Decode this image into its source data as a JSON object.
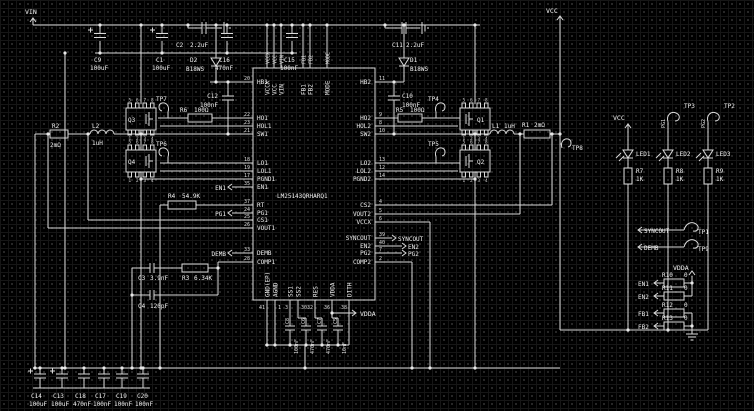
{
  "colors": {
    "bg": "#000000",
    "grid": "#343434",
    "wire": "#d9d9d9",
    "text": "#f1f1f1"
  },
  "nets": {
    "vin": "VIN",
    "vcc": "VCC",
    "vdda": "VDDA",
    "en1": "EN1",
    "en2": "EN2",
    "pg1": "PG1",
    "pg2": "PG2",
    "fb1": "FB1",
    "fb2": "FB2",
    "demb": "DEMB",
    "syncout": "SYNCOUT"
  },
  "ic": {
    "name": "LM25143QRHARQ1",
    "left_pins": [
      {
        "num": "20",
        "name": "HB1"
      },
      {
        "num": "22",
        "name": "HO1"
      },
      {
        "num": "23",
        "name": "HOL1"
      },
      {
        "num": "21",
        "name": "SW1"
      },
      {
        "num": "18",
        "name": "LO1"
      },
      {
        "num": "19",
        "name": "LOL1"
      },
      {
        "num": "17",
        "name": "PGND1"
      },
      {
        "num": "35",
        "name": "EN1"
      },
      {
        "num": "37",
        "name": "RT"
      },
      {
        "num": "24",
        "name": "PG1"
      },
      {
        "num": "25",
        "name": "CS1"
      },
      {
        "num": "26",
        "name": "VOUT1"
      },
      {
        "num": "33",
        "name": "DEMB"
      },
      {
        "num": "28",
        "name": "COMP1"
      }
    ],
    "right_pins": [
      {
        "num": "11",
        "name": "HB2"
      },
      {
        "num": "9",
        "name": "HO2"
      },
      {
        "num": "8",
        "name": "HOL2"
      },
      {
        "num": "10",
        "name": "SW2"
      },
      {
        "num": "13",
        "name": "LO2"
      },
      {
        "num": "12",
        "name": "LOL2"
      },
      {
        "num": "14",
        "name": "PGND2"
      },
      {
        "num": "4",
        "name": "CS2"
      },
      {
        "num": "5",
        "name": "VOUT2"
      },
      {
        "num": "6",
        "name": "VCCX"
      },
      {
        "num": "39",
        "name": "SYNCOUT"
      },
      {
        "num": "40",
        "name": "EN2"
      },
      {
        "num": "7",
        "name": "PG2"
      },
      {
        "num": "2",
        "name": "COMP2"
      }
    ],
    "top_pins": [
      "VCCX",
      "VCC",
      "VIN",
      "FB1",
      "FB2",
      "MODE"
    ],
    "bottom_pins": [
      {
        "num": "41",
        "name": "GND(EP)"
      },
      {
        "num": "1",
        "name": "AGND"
      },
      {
        "num": "3",
        "name": "SS1"
      },
      {
        "num": "30",
        "name": "SS2"
      },
      {
        "num": "32",
        "name": "RES"
      },
      {
        "num": "36",
        "name": "VDDA"
      },
      {
        "num": "38",
        "name": "DITH"
      }
    ]
  },
  "input_caps": [
    {
      "ref": "C9",
      "value": "100uF"
    },
    {
      "ref": "C1",
      "value": "100uF"
    },
    {
      "ref": "C16",
      "value": "470nF"
    },
    {
      "ref": "C15",
      "value": "100nF"
    }
  ],
  "output_caps": [
    {
      "ref": "C14",
      "value": "100uF"
    },
    {
      "ref": "C13",
      "value": "100uF"
    },
    {
      "ref": "C18",
      "value": "470nF"
    },
    {
      "ref": "C17",
      "value": "100nF"
    },
    {
      "ref": "C19",
      "value": "100nF"
    },
    {
      "ref": "C20",
      "value": "100nF"
    }
  ],
  "decoupling_caps": [
    {
      "ref": "C8",
      "value": "100nF"
    },
    {
      "ref": "C6",
      "value": "470nF"
    },
    {
      "ref": "C7",
      "value": "470nF"
    },
    {
      "ref": "C5",
      "value": "10nF"
    }
  ],
  "ch1": {
    "c2": {
      "ref": "C2",
      "value": "2.2uF"
    },
    "d2": {
      "ref": "D2",
      "value": "B18WS"
    },
    "c12": {
      "ref": "C12",
      "value": "100nF"
    },
    "r6": {
      "ref": "R6",
      "value": "100Ω"
    },
    "q3": "Q3",
    "q4": "Q4",
    "l2": {
      "ref": "L2",
      "value": "1uH"
    },
    "r2": {
      "ref": "R2",
      "value": "2mΩ"
    },
    "r4": {
      "ref": "R4",
      "value": "54.9K"
    },
    "c3": {
      "ref": "C3",
      "value": "3.9nF"
    },
    "r3": {
      "ref": "R3",
      "value": "6.34K"
    },
    "c4": {
      "ref": "C4",
      "value": "120pF"
    }
  },
  "ch2": {
    "c11": {
      "ref": "C11",
      "value": "2.2uF"
    },
    "d1": {
      "ref": "D1",
      "value": "B18WS"
    },
    "c10": {
      "ref": "C10",
      "value": "100nF"
    },
    "r5": {
      "ref": "R5",
      "value": "100Ω"
    },
    "q1": "Q1",
    "q2": "Q2",
    "l1": {
      "ref": "L1",
      "value": "1uH"
    },
    "r1": {
      "ref": "R1",
      "value": "2mΩ"
    }
  },
  "testpoints": {
    "tp1": "TP1",
    "tp2": "TP2",
    "tp3": "TP3",
    "tp4": "TP4",
    "tp5": "TP5",
    "tp6": "TP6",
    "tp7": "TP7",
    "tp8": "TP8",
    "tp9": "TP9"
  },
  "right": {
    "leds": [
      {
        "ref": "LED1"
      },
      {
        "ref": "LED2"
      },
      {
        "ref": "LED3"
      }
    ],
    "led_resistors": [
      {
        "ref": "R7",
        "value": "1K"
      },
      {
        "ref": "R8",
        "value": "1K"
      },
      {
        "ref": "R9",
        "value": "1K"
      }
    ],
    "pullups": [
      {
        "ref": "R10",
        "value": "0"
      },
      {
        "ref": "R11",
        "value": "0"
      },
      {
        "ref": "R12",
        "value": "0"
      },
      {
        "ref": "R13",
        "value": "0"
      }
    ]
  },
  "q_pins": {
    "top": [
      "5",
      "6",
      "7",
      "8"
    ],
    "bottom": [
      "1",
      "2",
      "3",
      "4"
    ]
  }
}
